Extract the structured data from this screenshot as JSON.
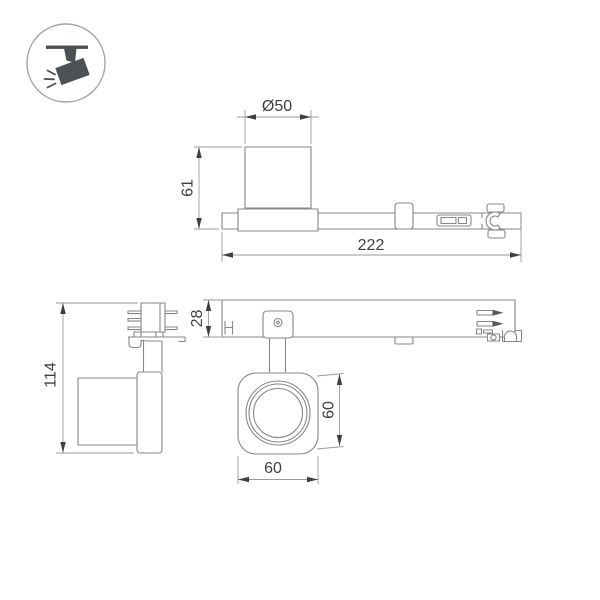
{
  "icon": {
    "name": "track-spotlight-icon"
  },
  "colors": {
    "background": "#ffffff",
    "drawing_line": "#878787",
    "dimension_line": "#9a9a9a",
    "text": "#3f3f3f",
    "icon_fill": "#4d5054"
  },
  "dimensions": {
    "top_view": {
      "diameter": "Ø50",
      "height": "61",
      "length": "222"
    },
    "side_view": {
      "height": "114"
    },
    "front_view": {
      "track_height": "28",
      "head_height": "60",
      "head_width": "60"
    }
  }
}
